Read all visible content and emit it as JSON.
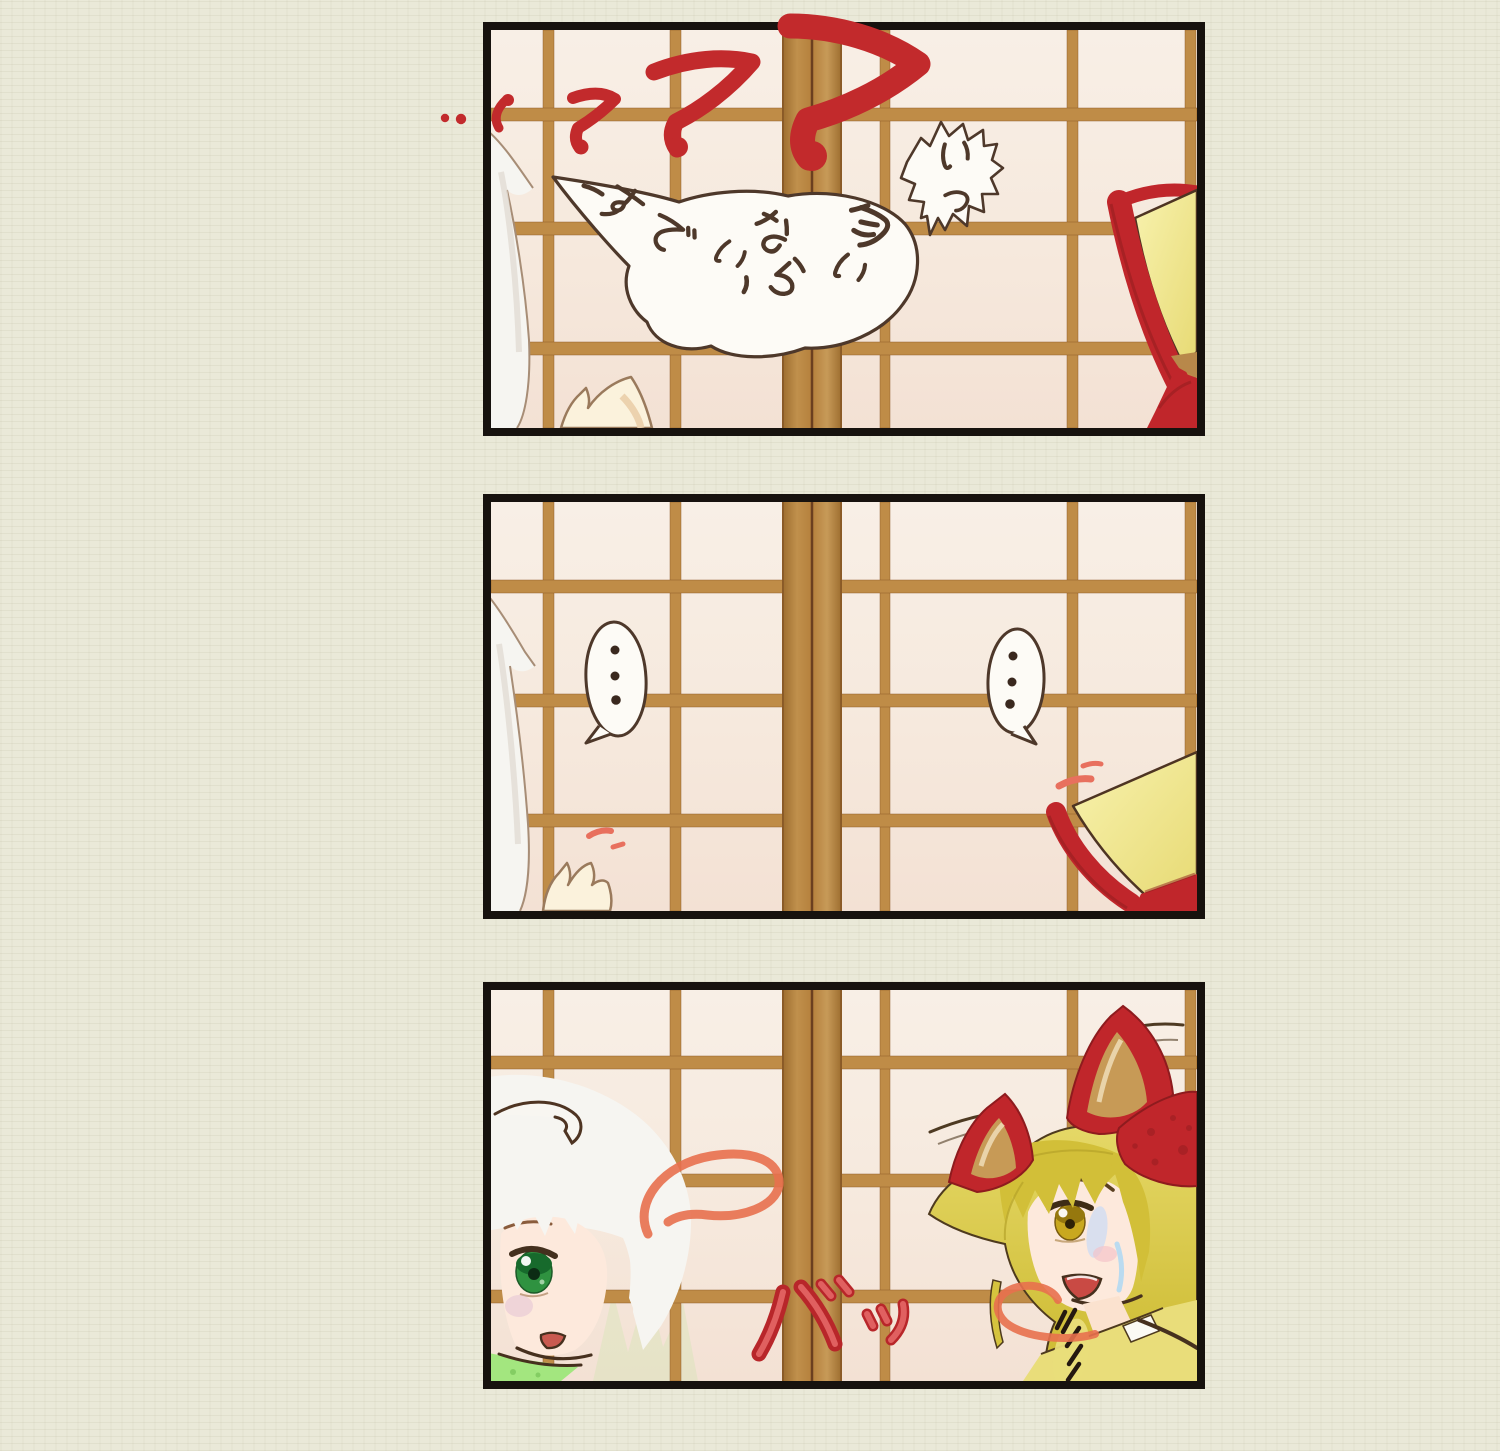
{
  "comic": {
    "panels": [
      {
        "id": "panel-1",
        "bubbles": [
          {
            "name": "sleep-talk-bubble",
            "text": "匂いなら すでに…"
          },
          {
            "name": "startle-bubble",
            "text": "いっ"
          }
        ],
        "sfx": [
          {
            "name": "zzz-sleep-marks",
            "text": "ZZZ"
          }
        ]
      },
      {
        "id": "panel-2",
        "bubbles": [
          {
            "name": "silence-bubble-left",
            "text": "・・・"
          },
          {
            "name": "silence-bubble-right",
            "text": "・・・"
          }
        ],
        "sfx": []
      },
      {
        "id": "panel-3",
        "bubbles": [],
        "sfx": [
          {
            "name": "door-burst-sfx",
            "text": "バッ"
          }
        ]
      }
    ],
    "colors": {
      "page_background": "#eae9d8",
      "panel_border": "#17120e",
      "shoji_paper": "#f7ece1",
      "wood_frame": "#bf8c47",
      "wood_stile": "#b5803c",
      "marker_red": "#c22a2c",
      "sfx_red_fill": "#dd5a55",
      "sfx_red_outline": "#b51f24",
      "motion_red": "#e8705e",
      "bubble_fill": "#fdfbf6",
      "bubble_outline": "#4e382a",
      "handwriting_ink": "#4e382a",
      "hair_white": "#f6f5f1",
      "hair_blonde": "#d8c63e",
      "bow_red": "#c0262b",
      "hat_yellow": "#efe38a",
      "eye_green": "#2f9240",
      "eye_yellow": "#c9a81f",
      "skin": "#fde9dc",
      "collar_green": "#a3e67f"
    }
  }
}
